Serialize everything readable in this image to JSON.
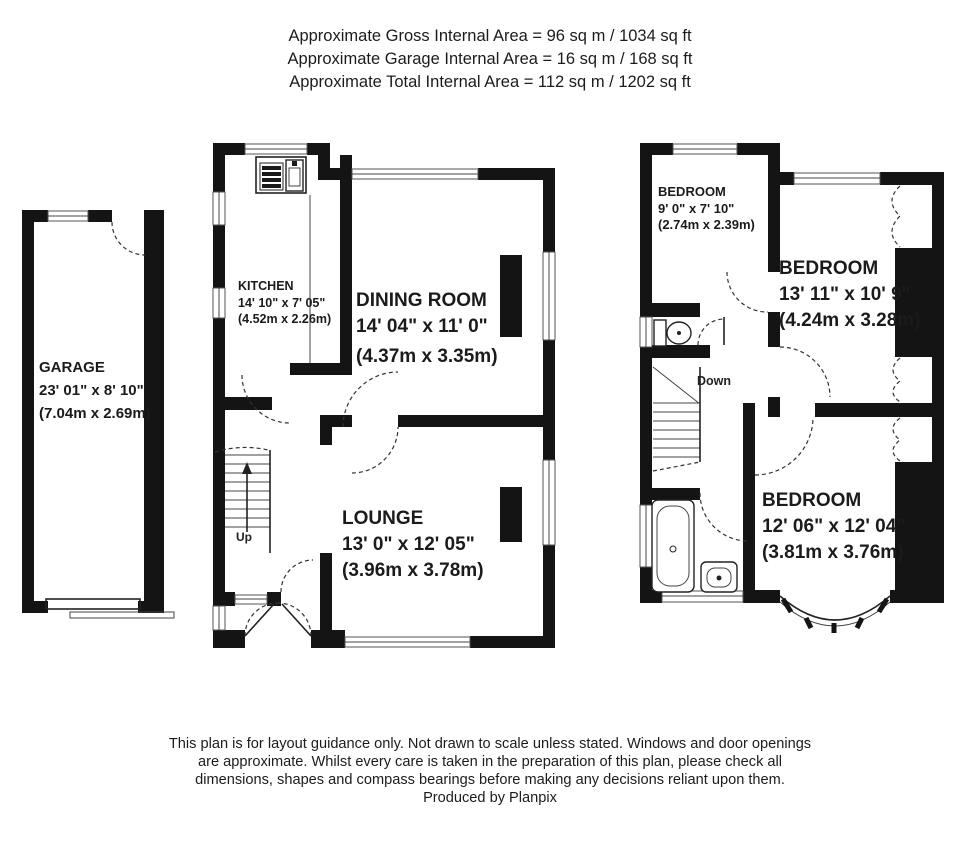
{
  "header": {
    "lines": [
      "Approximate Gross Internal Area = 96 sq m / 1034 sq ft",
      "Approximate Garage Internal Area = 16 sq m / 168 sq ft",
      "Approximate Total Internal Area = 112 sq m / 1202 sq ft"
    ]
  },
  "rooms": {
    "garage": {
      "name": "GARAGE",
      "imperial": "23' 01\" x 8' 10\"",
      "metric": "(7.04m x 2.69m)"
    },
    "kitchen": {
      "name": "KITCHEN",
      "imperial": "14' 10\" x 7' 05\"",
      "metric": "(4.52m x 2.26m)"
    },
    "dining": {
      "name": "DINING ROOM",
      "imperial": "14' 04\" x 11' 0\"",
      "metric": "(4.37m x 3.35m)"
    },
    "lounge": {
      "name": "LOUNGE",
      "imperial": "13' 0\" x 12' 05\"",
      "metric": "(3.96m x 3.78m)"
    },
    "bedroom1": {
      "name": "BEDROOM",
      "imperial": "9' 0\" x 7' 10\"",
      "metric": "(2.74m x 2.39m)"
    },
    "bedroom2": {
      "name": "BEDROOM",
      "imperial": "13' 11\" x 10' 9\"",
      "metric": "(4.24m x 3.28m)"
    },
    "bedroom3": {
      "name": "BEDROOM",
      "imperial": "12' 06\" x 12' 04\"",
      "metric": "(3.81m x 3.76m)"
    }
  },
  "stairs": {
    "up_label": "Up",
    "down_label": "Down"
  },
  "footer": {
    "lines": [
      "This plan is for layout guidance only. Not drawn to scale unless stated. Windows and door openings",
      "are approximate. Whilst every care is taken in the preparation of this plan, please check all",
      "dimensions, shapes and compass bearings before making any decisions reliant upon them."
    ],
    "credit": "Produced by Planpix"
  },
  "colors": {
    "wall": "#141414",
    "text": "#1b1b1b",
    "background": "#ffffff"
  }
}
